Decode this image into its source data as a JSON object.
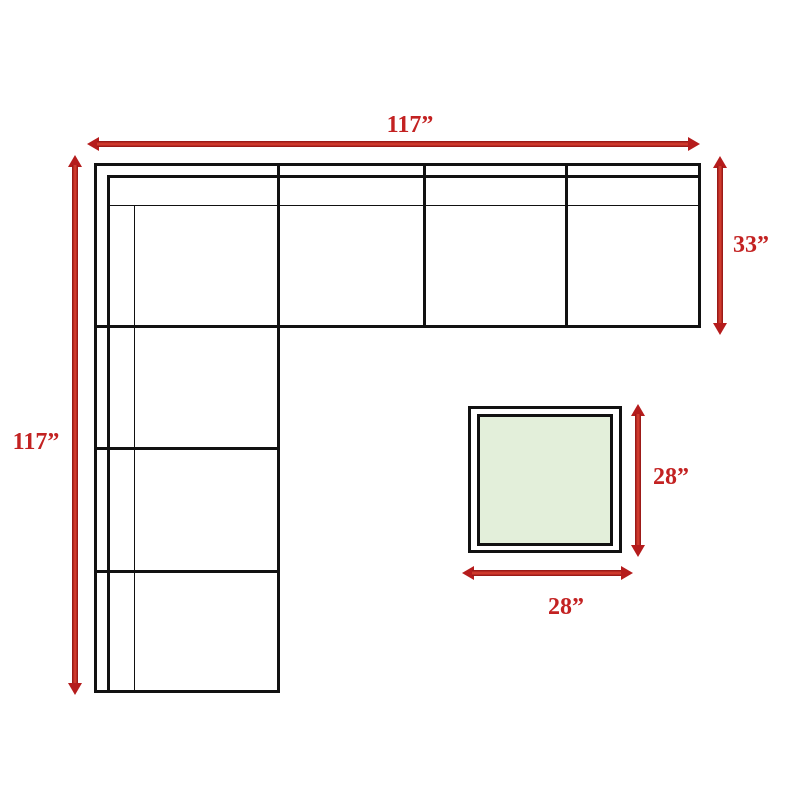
{
  "diagram_title": "Sectional sofa with ottoman dimension diagram",
  "sofa": {
    "width_label": "117”",
    "height_label": "117”",
    "depth_label": "33”",
    "width_inches": 117,
    "height_inches": 117,
    "depth_inches": 33,
    "sections_across_top": 4,
    "sections_down_left": 4,
    "shape": "L-sectional"
  },
  "ottoman": {
    "width_label": "28”",
    "height_label": "28”",
    "width_inches": 28,
    "height_inches": 28,
    "shape": "square"
  },
  "colors": {
    "dimension_red": "#c32222",
    "line_black": "#111111",
    "ottoman_fill": "#e3efda"
  }
}
